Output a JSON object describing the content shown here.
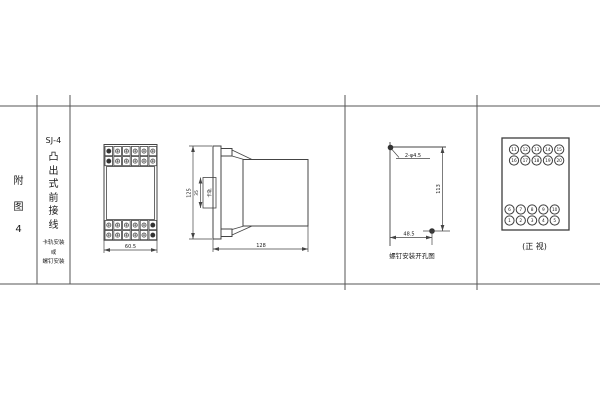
{
  "page": {
    "background": "#ffffff",
    "line_color": "#444444",
    "text_color": "#1a1a1a"
  },
  "title_block": {
    "figure_label_chars": [
      "附",
      "图",
      "4"
    ],
    "model": "SJ-4",
    "description_chars": [
      "凸",
      "出",
      "式",
      "前",
      "接",
      "线"
    ],
    "mounting_lines": [
      "卡轨安装",
      "或",
      "螺钉安装"
    ]
  },
  "front_view": {
    "width_dim": "60.5"
  },
  "side_view": {
    "height_dim": "125",
    "depth_dim": "128",
    "rail_dim": "35",
    "rail_label": "卡轨"
  },
  "drill_view": {
    "hole_spec": "2-φ4.5",
    "vertical_dim": "113",
    "horizontal_dim": "48.5",
    "caption": "螺钉安装开孔图"
  },
  "terminal_view": {
    "caption": "(正 视)",
    "rows": [
      [
        "11",
        "12",
        "13",
        "14",
        "15"
      ],
      [
        "16",
        "17",
        "18",
        "19",
        "20"
      ],
      [
        "6",
        "7",
        "8",
        "9",
        "10"
      ],
      [
        "1",
        "2",
        "3",
        "4",
        "5"
      ]
    ]
  }
}
